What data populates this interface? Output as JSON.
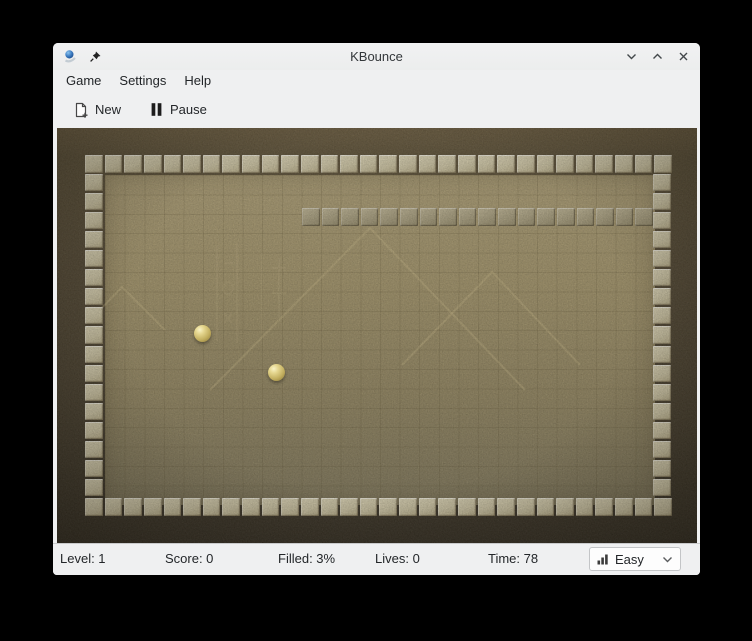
{
  "window": {
    "title": "KBounce"
  },
  "menubar": {
    "items": [
      {
        "label": "Game"
      },
      {
        "label": "Settings"
      },
      {
        "label": "Help"
      }
    ]
  },
  "toolbar": {
    "buttons": [
      {
        "label": "New",
        "icon": "new-document-icon"
      },
      {
        "label": "Pause",
        "icon": "pause-icon"
      }
    ]
  },
  "statusbar": {
    "level": "Level: 1",
    "score": "Score: 0",
    "filled": "Filled: 3%",
    "lives": "Lives: 0",
    "time": "Time: 78",
    "difficulty": {
      "selected": "Easy",
      "icon": "difficulty-bars-icon"
    }
  },
  "game": {
    "board": {
      "cols": 30,
      "rows": 19,
      "top": 30,
      "bottom": 30,
      "left": 17,
      "right": 17,
      "wall": 18
    },
    "balls": [
      {
        "x": 145,
        "y": 205
      },
      {
        "x": 219,
        "y": 244
      }
    ],
    "background": {
      "pyramids": [
        "153,262 313,100 468,262",
        "345,237 435,144 523,237",
        "33,192 65,159 108,202"
      ]
    },
    "colors": {
      "chrome": "#eff0f1",
      "text": "#232629",
      "canvas_dark": "#3a3223",
      "field_top": "#ac9d73",
      "field_bottom": "#7e7558",
      "tile": "#cfc6a4",
      "wall_tile": "#a99f7e",
      "ball": "#d8c878"
    }
  }
}
